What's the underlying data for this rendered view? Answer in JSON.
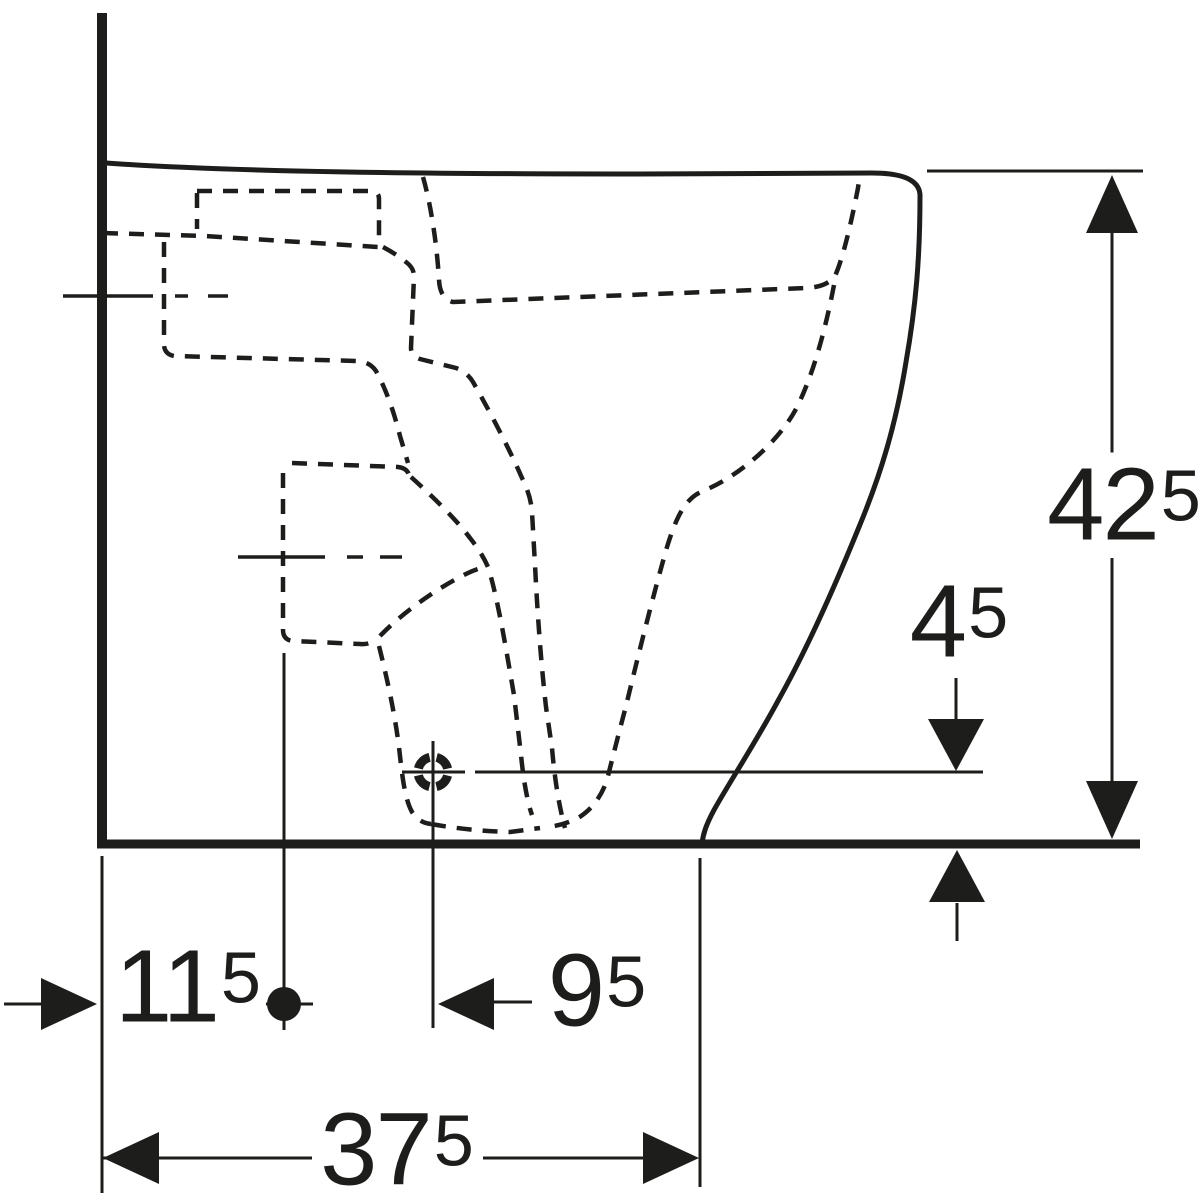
{
  "drawing": {
    "colors": {
      "ink": "#1d1d1b",
      "background": "#ffffff"
    },
    "dimensions": {
      "overall_height": {
        "main": "42",
        "sup": "5"
      },
      "outlet_center_height": {
        "main": "4",
        "sup": "5"
      },
      "wall_to_drain_center": {
        "main": "11",
        "sup": "5"
      },
      "drain_to_outlet_center": {
        "main": "9",
        "sup": "5"
      },
      "wall_to_front_edge": {
        "main": "37",
        "sup": "5"
      }
    }
  }
}
